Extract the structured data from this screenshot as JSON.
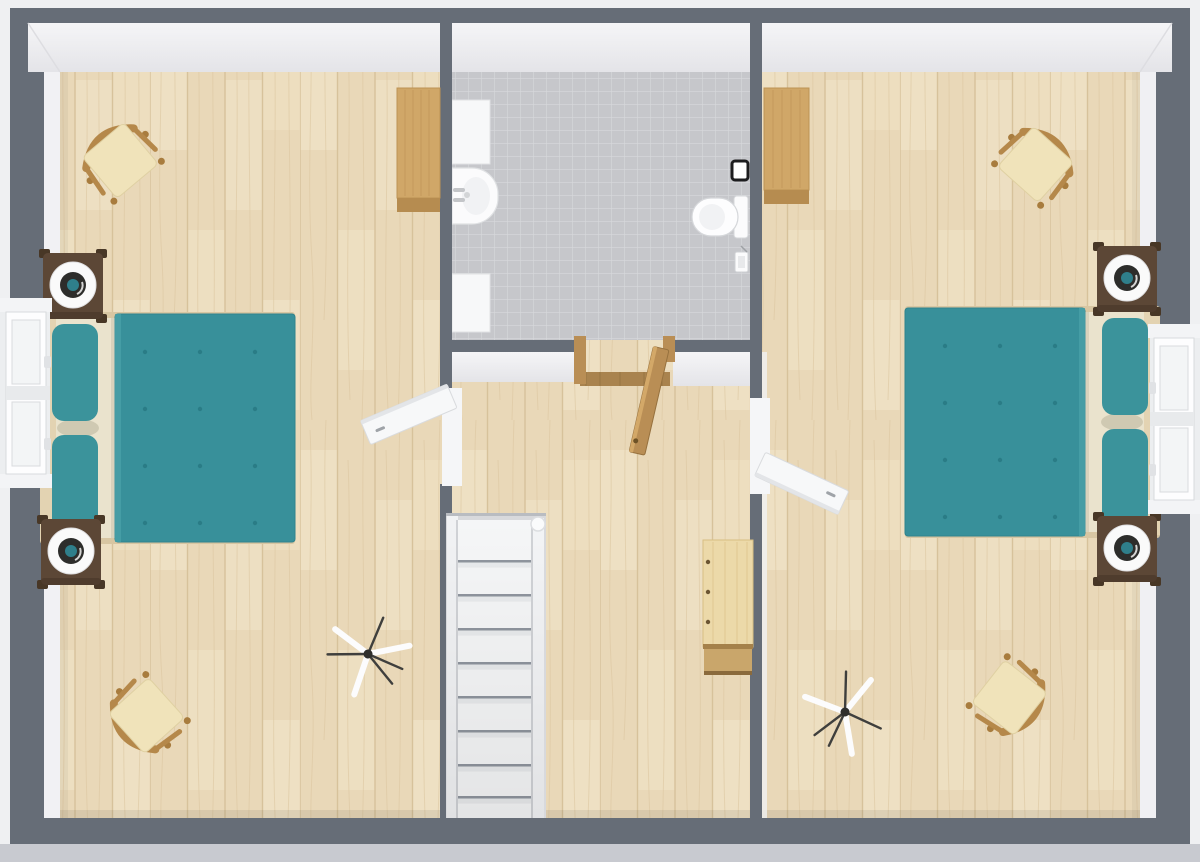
{
  "scene": {
    "description": "3D top-down floor plan of an upper storey: two bedrooms flanking a central bathroom and a hallway with a staircase",
    "rooms": [
      "left-bedroom",
      "bathroom",
      "hallway",
      "right-bedroom"
    ]
  },
  "colors": {
    "background": "#eff0f2",
    "exterior_apron": "#c8cad0",
    "wall": "#666d77",
    "wall_face": "#f1f1f4",
    "floor_wood": "#e9d8b8",
    "plank_line": "#d7c29b",
    "plank_light": "#f2e6cc",
    "tile": "#c6c7cb",
    "tile_grout": "#d8d9dc",
    "bed_teal": "#38909a",
    "bed_teal_dark": "#2a7c86",
    "pillow_teal": "#3b939b",
    "sheet_cream": "#eae3cd",
    "bed_frame_wood": "#d8c6a2",
    "headboard_wood": "#e3d3b2",
    "nightstand_brown": "#5c4736",
    "lamp_white": "#fafafa",
    "lamp_dark": "#2d2d2b",
    "lamp_teal": "#2f7f8b",
    "chair_wood": "#b5884a",
    "chair_cushion": "#f0e3ba",
    "wardrobe_wood": "#d0a768",
    "wardrobe_shadow": "#b68c50",
    "door_wood": "#b98e55",
    "threshold_wood": "#a9834e",
    "white_door": "#f7f8f9",
    "desk_wood": "#ecd9a9",
    "desk_wood_dark": "#c9a66b",
    "stair_tread": "#f5f6f7",
    "stair_line": "#8f959e",
    "fixture_white": "#fbfbfc",
    "fixture_stroke": "#d5d7da"
  },
  "rooms": {
    "left_bedroom": {
      "name": "left bedroom",
      "furniture": [
        "double bed with teal duvet",
        "2 nightstands with round lamps",
        "2 wooden chairs with cream cushions",
        "tripod floor lamp",
        "wooden wardrobe",
        "window",
        "white hinged door"
      ]
    },
    "bathroom": {
      "name": "bathroom",
      "furniture": [
        "wash basin with faucet",
        "2 white wall cabinets",
        "toilet",
        "toilet paper holder",
        "flush plate",
        "open wooden door",
        "gray tiled floor"
      ]
    },
    "hallway": {
      "name": "hallway / landing",
      "furniture": [
        "white staircase with railing",
        "wooden desk"
      ]
    },
    "right_bedroom": {
      "name": "right bedroom",
      "furniture": [
        "double bed with teal duvet",
        "2 nightstands with round lamps",
        "2 wooden chairs with cream cushions",
        "tripod floor lamp",
        "wooden wardrobe",
        "window",
        "white hinged door"
      ]
    }
  }
}
